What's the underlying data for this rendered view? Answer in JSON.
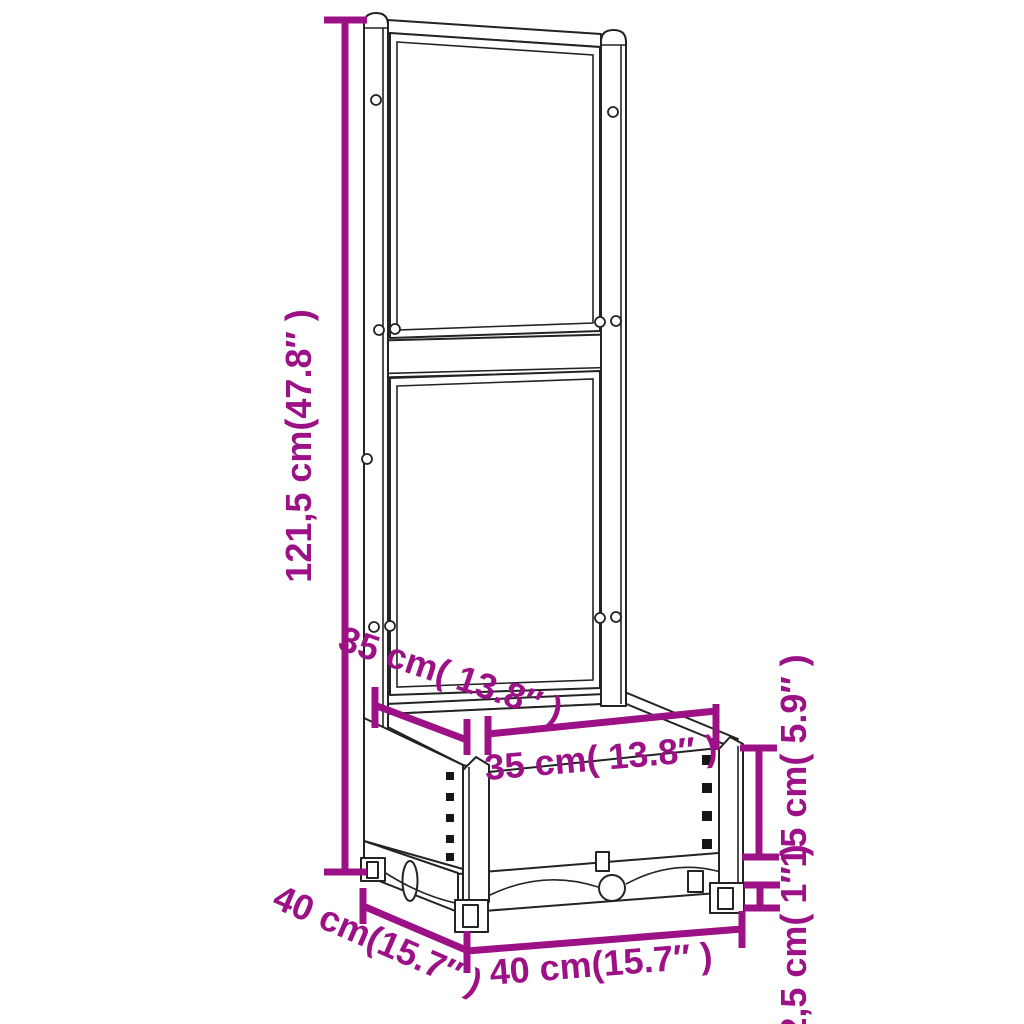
{
  "figure": {
    "accent_color": "#9C1185",
    "line_color": "#232323",
    "background": "#ffffff",
    "labels": {
      "total_height": "121,5 cm(47.8″ )",
      "trellis_depth": "35 cm( 13.8″ )",
      "inner_width": "35 cm( 13.8″ )",
      "box_height": "15 cm( 5.9″ )",
      "foot_height": "2,5 cm( 1″ )",
      "front_width": "40 cm(15.7″ )",
      "side_depth": "40 cm(15.7″ )"
    }
  }
}
